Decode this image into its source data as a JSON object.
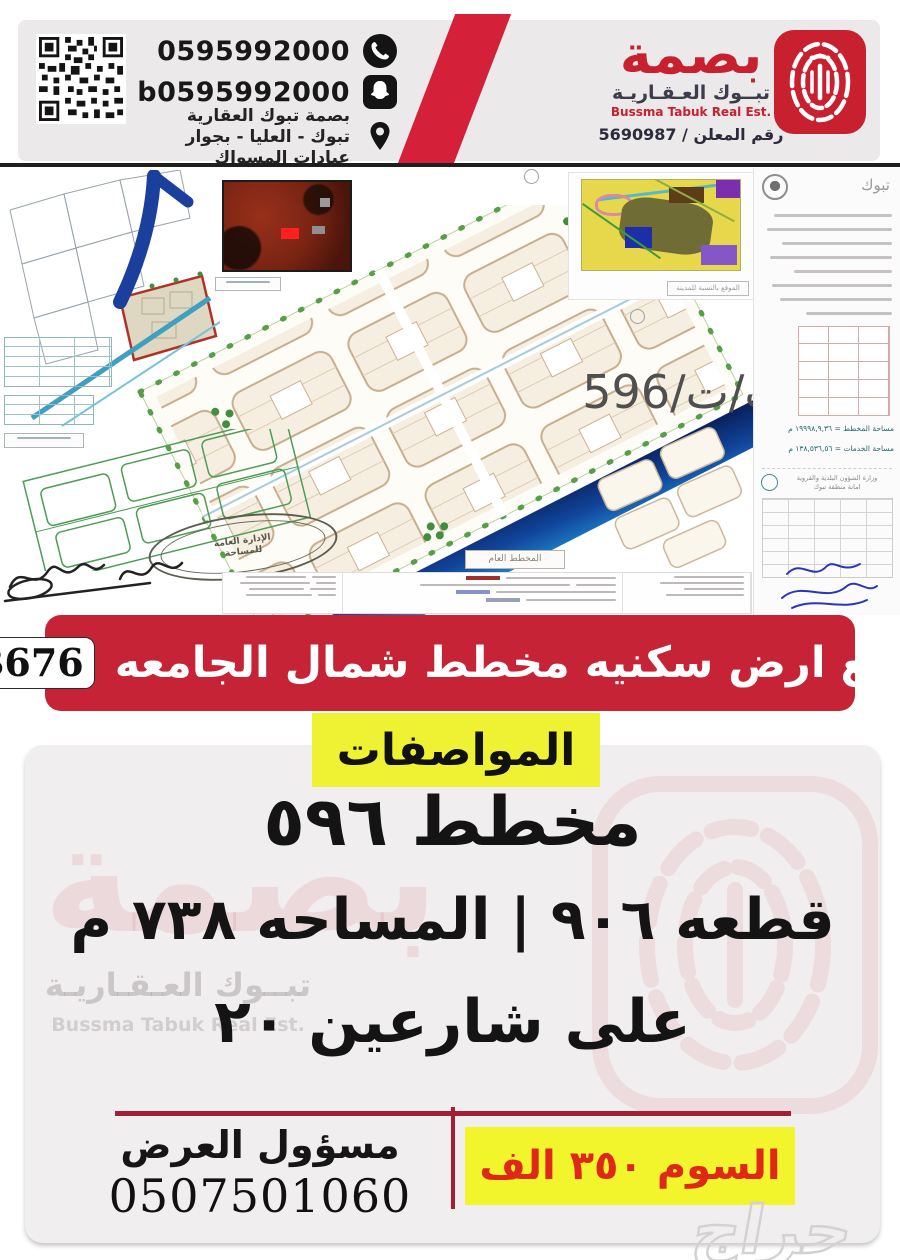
{
  "header": {
    "whatsapp_number": "0595992000",
    "snapchat_account": "b0595992000",
    "company_name": "بصمة تبوك العقارية",
    "address": "تبوك - العليا - بجوار عيادات المسواك",
    "brand": {
      "name_ar": "بصمة",
      "tagline_ar": "تبــوك العـقـاريـة",
      "tagline_en": "Bussma Tabuk Real Est.",
      "advertiser_number": "رقم المعلن / 5690987"
    }
  },
  "plans": {
    "reference": "ت/ت/596",
    "master_plan_label": "المخطط العام",
    "city_location_label": "الموقع بالنسبة للمدينة",
    "stamp_line1": "الإدارة العامة",
    "stamp_line2": "للمساحة",
    "document": {
      "city": "تبوك",
      "ministry_line1": "وزارة الشؤون البلدية والقروية",
      "ministry_line2": "امانة منطقة تبوك",
      "area_line1": "مساحة المخطط = ١٩٩٩٨,٩,٣٦ م",
      "area_line2": "مساحة الخدمات = ١٣٨,٥٣٦,٥٦ م"
    }
  },
  "banner": {
    "title": "للبيع ارض سكنيه مخطط شمال الجامعه",
    "badge": "B676"
  },
  "specs": {
    "heading": "المواصفات",
    "plan_line": "مخطط ٥٩٦",
    "plot_line": "قطعه ٩٠٦ | المساحه ٧٣٨ م",
    "streets_line": "على شارعين ٢٠"
  },
  "footer": {
    "contact_label": "مسؤول العرض",
    "phone": "0507501060",
    "price_label": "السوم ٣٥٠ الف",
    "site_watermark": "حراج"
  },
  "watermark": {
    "brand_mark": "بصمة",
    "tagline_ar": "تبــوك العـقـاريـة",
    "tagline_en": "Bussma Tabuk Real Est."
  },
  "icons": {
    "whatsapp": "whatsapp-icon",
    "snapchat": "snapchat-icon",
    "location": "location-pin-icon",
    "qr": "qr-code",
    "fingerprint": "fingerprint-logo"
  },
  "colors": {
    "brand_red": "#c8202f",
    "banner_red": "#c72336",
    "stripe_red": "#d42038",
    "accent_yellow": "#eef233",
    "price_yellow": "#f3f52c",
    "price_red": "#e02818",
    "divider_red": "#a22034",
    "road_blue_light": "#25a5e0",
    "road_blue_dark": "#081c55",
    "header_gray": "#ebe9ea",
    "specs_bg": "#f1eeef"
  }
}
